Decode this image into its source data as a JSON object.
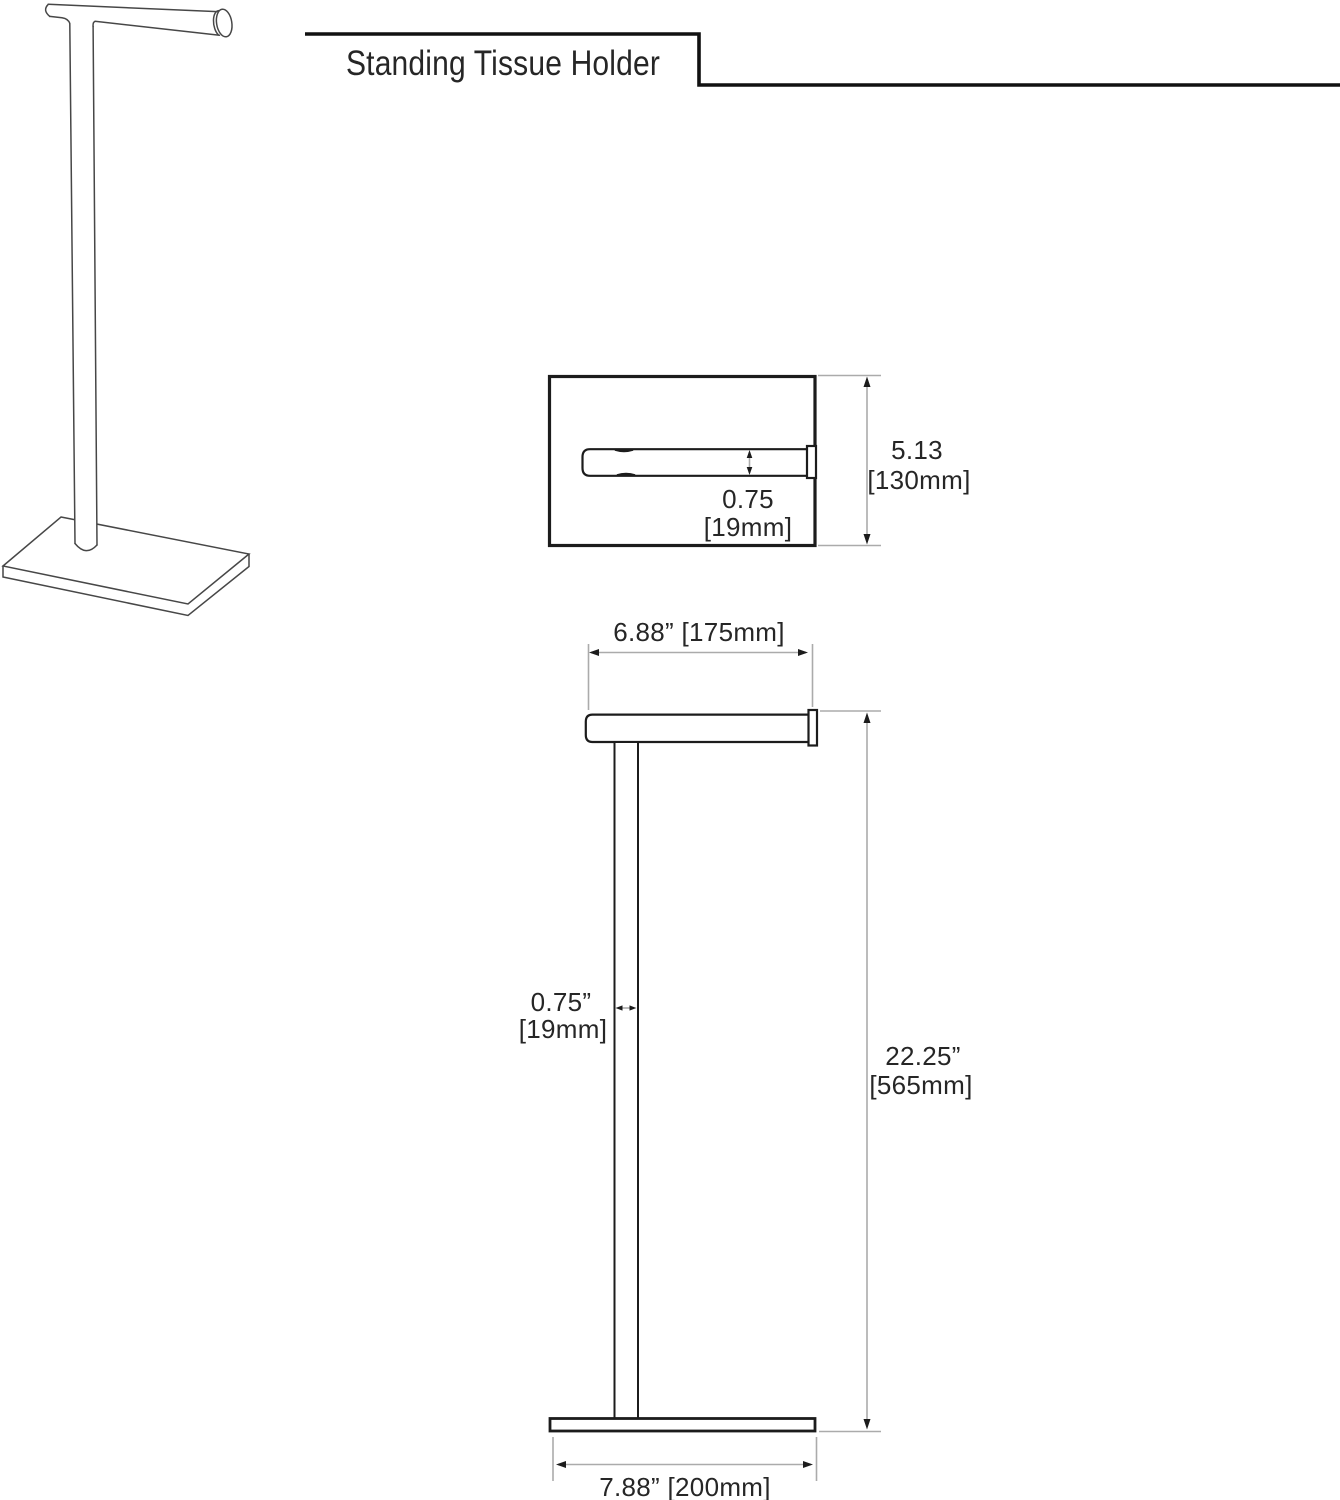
{
  "title": "Standing Tissue Holder",
  "top_view": {
    "bar_diameter_in": "0.75",
    "bar_diameter_mm": "[19mm]",
    "depth_in": "5.13",
    "depth_mm": "[130mm]"
  },
  "front_view": {
    "bar_length": "6.88” [175mm]",
    "pole_diameter_in": "0.75”",
    "pole_diameter_mm": "[19mm]",
    "height_in": "22.25”",
    "height_mm": "[565mm]",
    "base_width": "7.88” [200mm]"
  },
  "colors": {
    "object_line": "#1c1c1c",
    "perspective_line": "#474747",
    "dimension_line": "#ababab",
    "text": "#262626",
    "background": "#ffffff"
  }
}
